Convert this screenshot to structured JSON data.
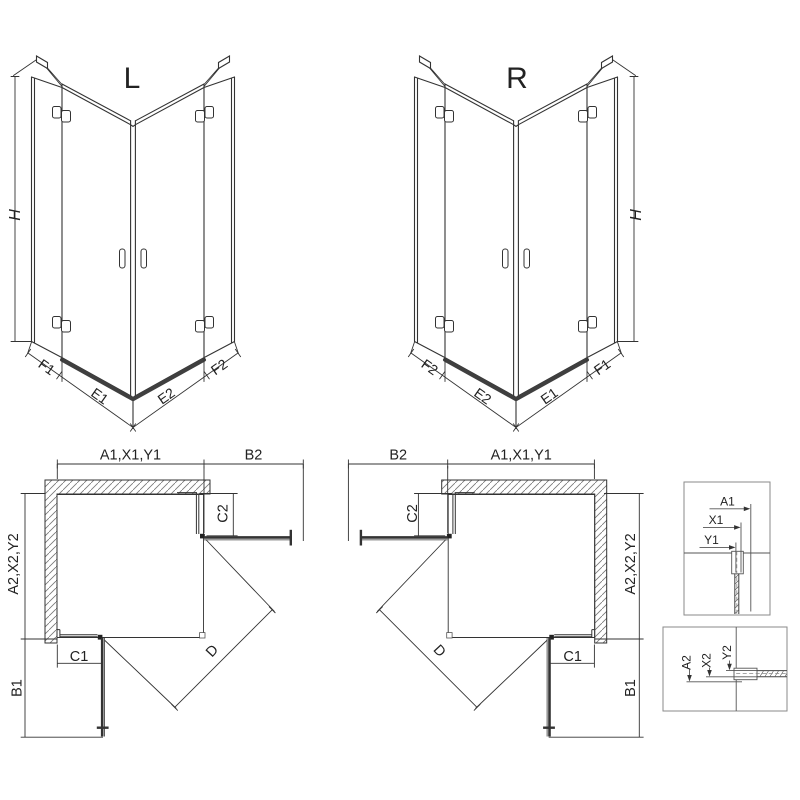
{
  "drawing": {
    "iso_left": {
      "title": "L",
      "h": "H",
      "f1": "F1",
      "e1": "E1",
      "e2": "E2",
      "f2": "F2"
    },
    "iso_right": {
      "title": "R",
      "h": "H",
      "f1": "F1",
      "e1": "E1",
      "e2": "E2",
      "f2": "F2"
    },
    "plan_left": {
      "a1": "A1,X1,Y1",
      "b2": "B2",
      "c2": "C2",
      "a2": "A2,X2,Y2",
      "c1": "C1",
      "b1": "B1",
      "d": "D"
    },
    "plan_right": {
      "a1": "A1,X1,Y1",
      "b2": "B2",
      "c2": "C2",
      "a2": "A2,X2,Y2",
      "c1": "C1",
      "b1": "B1",
      "d": "D"
    },
    "detail_top": {
      "a1": "A1",
      "x1": "X1",
      "y1": "Y1"
    },
    "detail_bottom": {
      "a2": "A2",
      "x2": "X2",
      "y2": "Y2"
    }
  },
  "colors": {
    "line": "#333333",
    "dark": "#222222",
    "threshold": "#3f3f3f",
    "hatch": "#777777",
    "box_border": "#8a8a8a"
  }
}
